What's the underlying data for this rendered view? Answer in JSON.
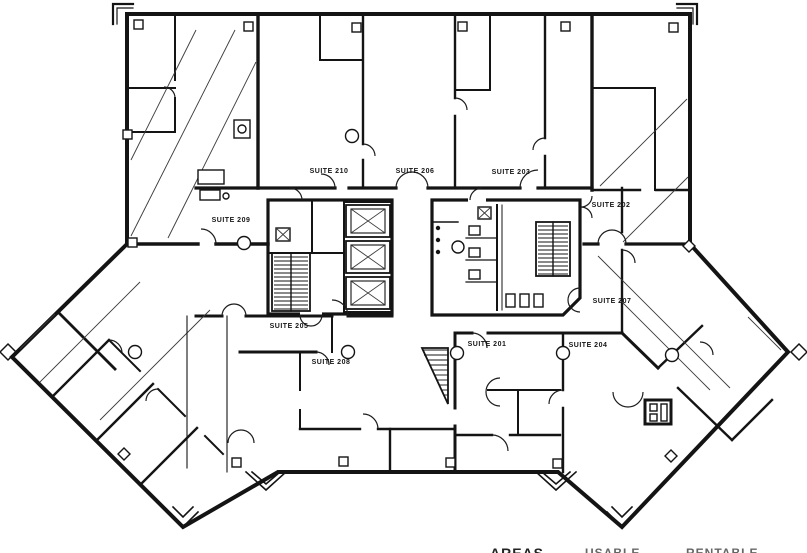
{
  "palette": {
    "background": "#ffffff",
    "ink": "#141414"
  },
  "floor_plan": {
    "suites": [
      "SUITE 210",
      "SUITE 206",
      "SUITE 203",
      "SUITE 202",
      "SUITE 209",
      "SUITE 205",
      "SUITE 208",
      "SUITE 201",
      "SUITE 204",
      "SUITE 207"
    ],
    "legend": {
      "labels": [
        "AREAS",
        "USABLE",
        "RENTABLE"
      ]
    },
    "symbols": {
      "elevator": "x-box-shaft",
      "stairwell": "hatched-treads",
      "door": "quarter-arc-swing",
      "column": "square-marker",
      "wall_column": "circle-marker"
    }
  }
}
